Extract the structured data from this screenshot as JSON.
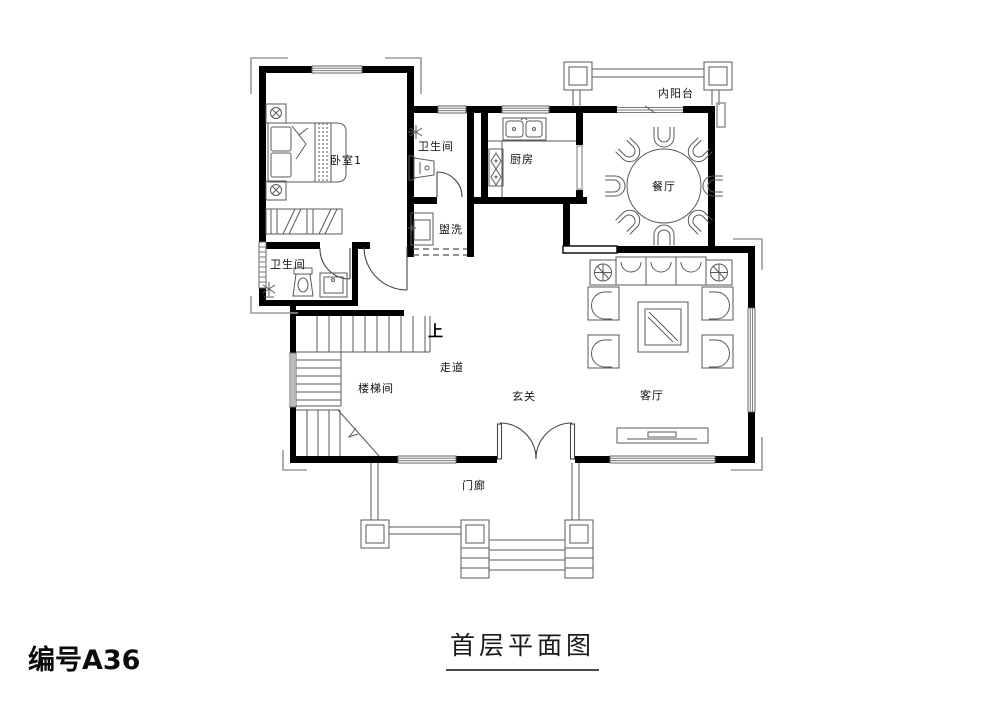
{
  "drawing": {
    "number": "编号A36",
    "title": "首层平面图"
  },
  "rooms": {
    "bedroom": "卧室1",
    "bathroom_top": "卫生间",
    "bathroom_bottom": "卫生间",
    "wash": "盥洗",
    "kitchen": "厨房",
    "dining": "餐厅",
    "living": "客厅",
    "entry": "玄关",
    "corridor": "走道",
    "stairwell": "楼梯间",
    "porch": "门廊",
    "balcony": "内阳台"
  },
  "annotations": {
    "stairs_up": "上"
  },
  "colors": {
    "wall": "#000000",
    "furniture_line": "#5a5a5a",
    "window_line": "#666666",
    "pilaster_line": "#9a9a9a",
    "text": "#111111",
    "background": "#ffffff"
  }
}
